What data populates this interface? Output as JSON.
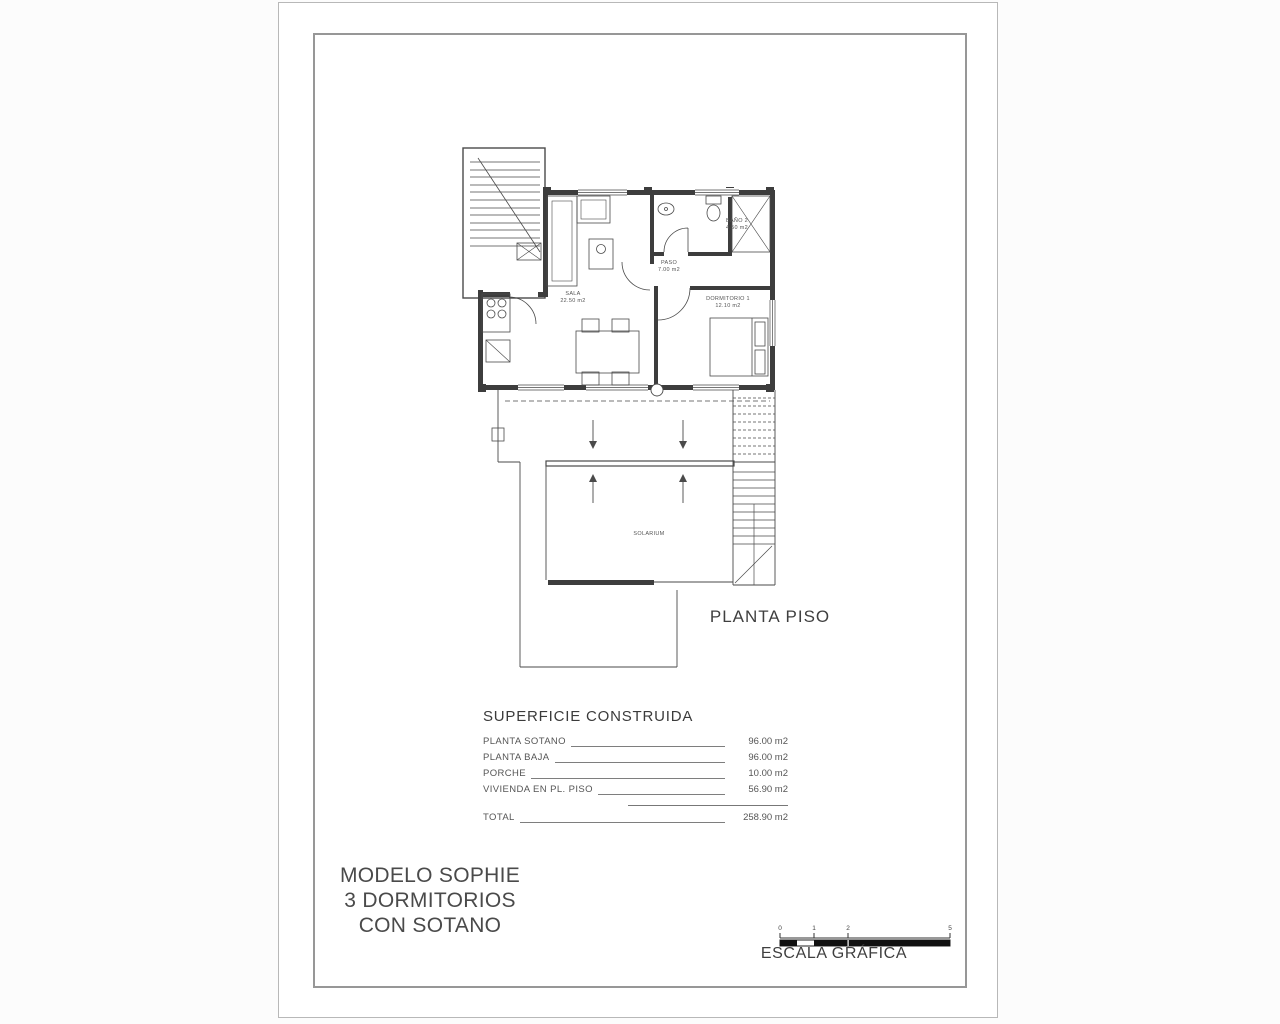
{
  "plan": {
    "title": "PLANTA PISO",
    "rooms": {
      "sala": {
        "name": "SALA",
        "area": "22.50 m2"
      },
      "paso": {
        "name": "PASO",
        "area": "7.00 m2"
      },
      "bano": {
        "name": "BAÑO 2",
        "area": "4.50 m2"
      },
      "dormitorio": {
        "name": "DORMITORIO 1",
        "area": "12.10 m2"
      },
      "solarium": {
        "name": "SOLARIUM"
      }
    }
  },
  "areas_table": {
    "title": "SUPERFICIE CONSTRUIDA",
    "rows": [
      {
        "label": "PLANTA SOTANO",
        "value": "96.00 m2"
      },
      {
        "label": "PLANTA BAJA",
        "value": "96.00 m2"
      },
      {
        "label": "PORCHE",
        "value": "10.00 m2"
      },
      {
        "label": "VIVIENDA EN PL. PISO",
        "value": "56.90 m2"
      }
    ],
    "total_label": "TOTAL",
    "total_value": "258.90 m2"
  },
  "model": {
    "line1": "MODELO SOPHIE",
    "line2": "3 DORMITORIOS",
    "line3": "CON SOTANO"
  },
  "scale": {
    "label": "ESCALA GRÁFICA",
    "ticks": [
      "0",
      "1",
      "2",
      "5"
    ]
  },
  "colors": {
    "ink": "#4a4a4a",
    "wall": "#3d3d3d",
    "paper": "#ffffff",
    "frame": "#979797"
  }
}
